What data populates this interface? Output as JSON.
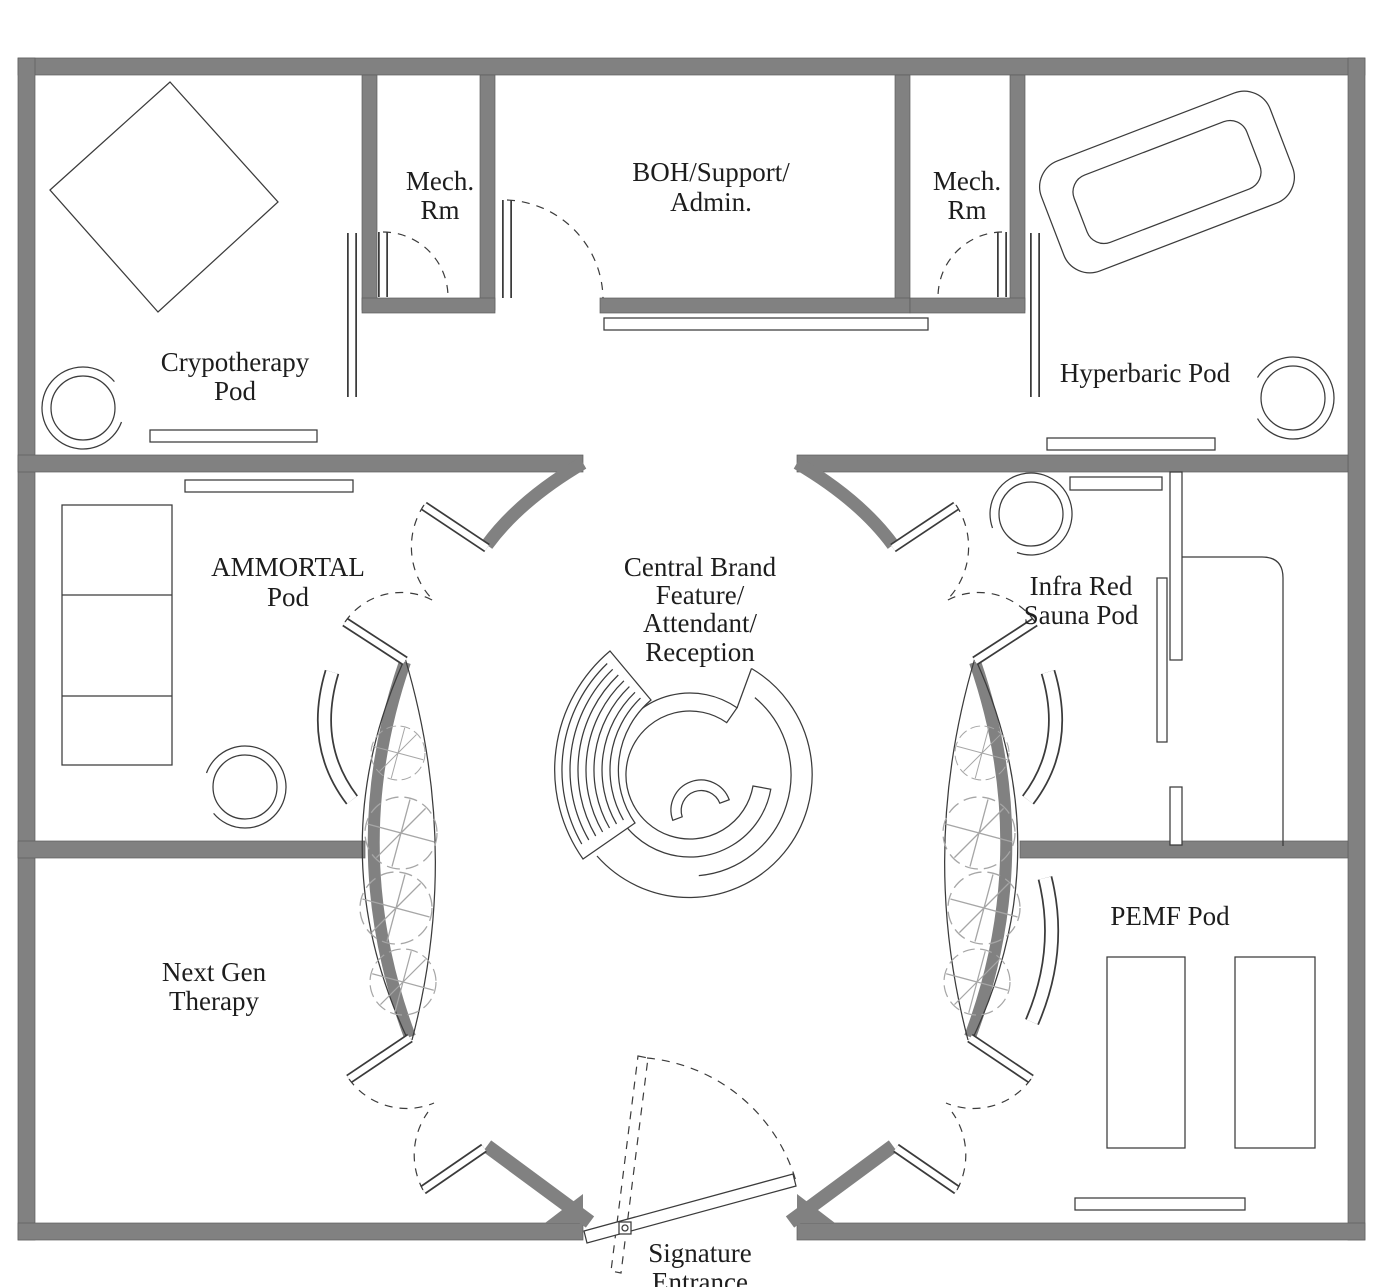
{
  "colors": {
    "wall": "#818181",
    "line": "#3b3b3b",
    "tree": "#a6a6a6",
    "text": "#1d1d1d",
    "background": "#ffffff"
  },
  "labels": {
    "cryotherapy_pod": {
      "lines": [
        "Crypotherapy",
        "Pod"
      ]
    },
    "mech_rm_left": {
      "lines": [
        "Mech.",
        "Rm"
      ]
    },
    "boh_support_admin": {
      "lines": [
        "BOH/Support/",
        "Admin."
      ]
    },
    "mech_rm_right": {
      "lines": [
        "Mech.",
        "Rm"
      ]
    },
    "hyperbaric_pod": {
      "lines": [
        "Hyperbaric Pod"
      ]
    },
    "ammortal_pod": {
      "lines": [
        "AMMORTAL",
        "Pod"
      ]
    },
    "central_brand": {
      "lines": [
        "Central Brand",
        "Feature/",
        "Attendant/",
        "Reception"
      ]
    },
    "infra_red_sauna_pod": {
      "lines": [
        "Infra Red",
        "Sauna Pod"
      ]
    },
    "next_gen_therapy": {
      "lines": [
        "Next Gen",
        "Therapy"
      ]
    },
    "pemf_pod": {
      "lines": [
        "PEMF Pod"
      ]
    },
    "signature_entrance": {
      "lines": [
        "Signature",
        "Entrance"
      ]
    }
  }
}
